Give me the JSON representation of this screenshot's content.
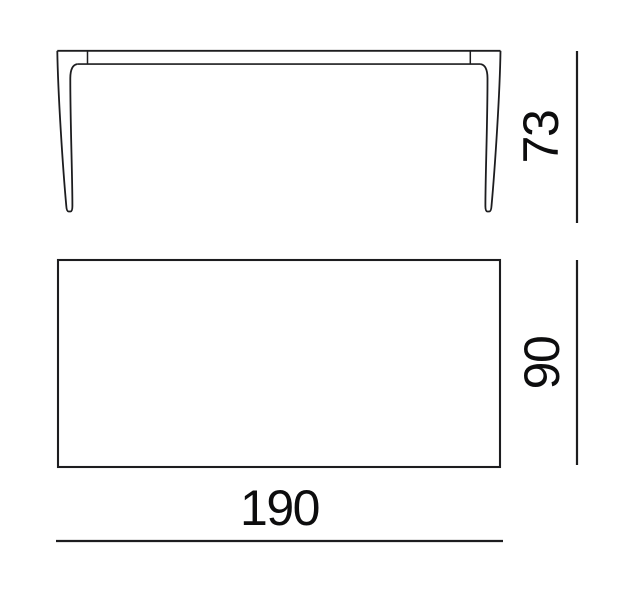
{
  "diagram": {
    "kind": "furniture-dimension-drawing",
    "dimensions": {
      "height": {
        "label": "73"
      },
      "depth": {
        "label": "90"
      },
      "width": {
        "label": "190"
      }
    },
    "colors": {
      "background": "#ffffff",
      "line": "#1d1d1f",
      "text": "#0d0d0e"
    }
  }
}
